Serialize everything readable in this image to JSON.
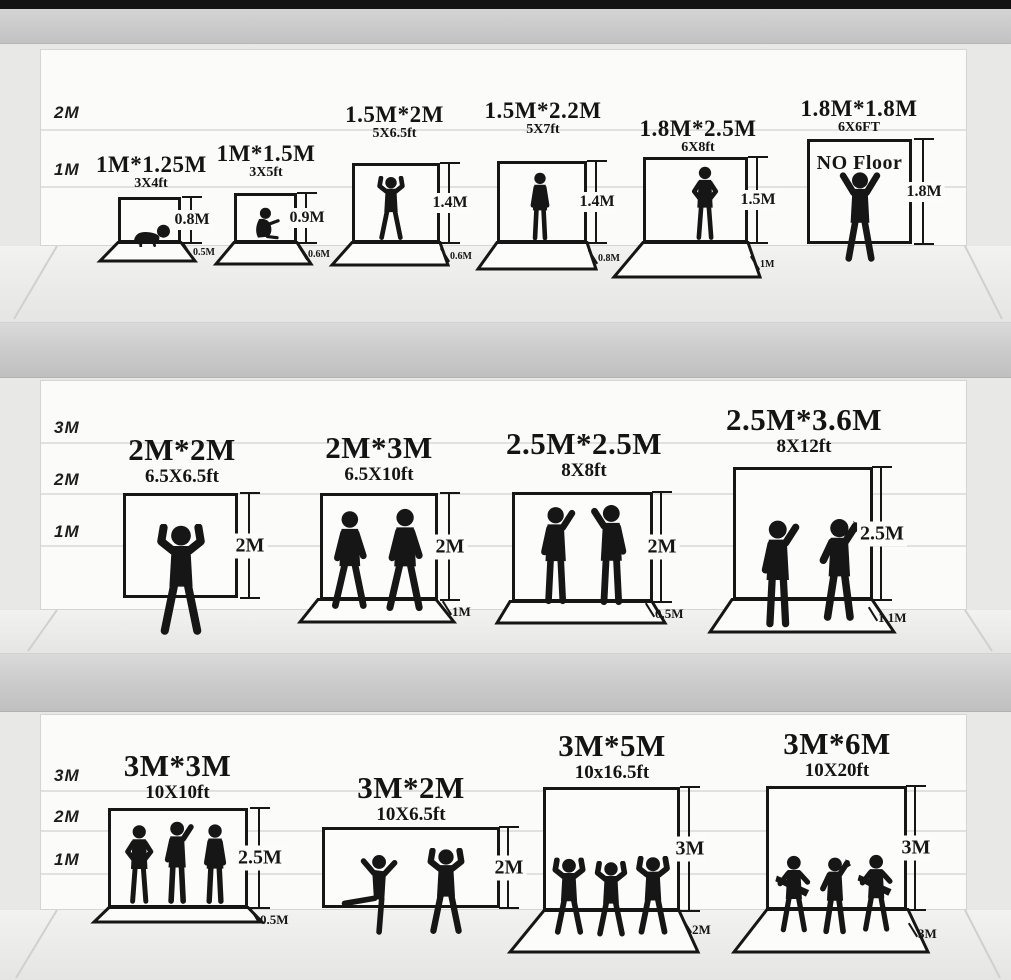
{
  "palette": {
    "ink": "#161616",
    "wall": "#fbfbfa",
    "floor": "#ededeb",
    "divider": "#c9c9c9",
    "side_wall": "#e8e8e6",
    "top_bar": "#121212",
    "grid_line": "#e1e1df"
  },
  "rows": [
    {
      "axis": [
        "2M",
        "1M"
      ],
      "panels": [
        {
          "size_m": "1M*1.25M",
          "size_ft": "3X4ft",
          "height": "0.8M",
          "floor": "0.5M",
          "figure": "baby-crawling"
        },
        {
          "size_m": "1M*1.5M",
          "size_ft": "3X5ft",
          "height": "0.9M",
          "floor": "0.6M",
          "figure": "toddler-sitting"
        },
        {
          "size_m": "1.5M*2M",
          "size_ft": "5X6.5ft",
          "height": "1.4M",
          "floor": "0.6M",
          "figure": "child-arms-raised"
        },
        {
          "size_m": "1.5M*2.2M",
          "size_ft": "5X7ft",
          "height": "1.4M",
          "floor": "0.8M",
          "figure": "boy-standing"
        },
        {
          "size_m": "1.8M*2.5M",
          "size_ft": "6X8ft",
          "height": "1.5M",
          "floor": "1M",
          "figure": "man-hands-on-hips"
        },
        {
          "size_m": "1.8M*1.8M",
          "size_ft": "6X6FT",
          "height": "1.8M",
          "no_floor_note": "NO Floor",
          "figure": "man-arms-up-v"
        }
      ]
    },
    {
      "axis": [
        "3M",
        "2M",
        "1M"
      ],
      "panels": [
        {
          "size_m": "2M*2M",
          "size_ft": "6.5X6.5ft",
          "height": "2M",
          "figure": "man-victory-arms"
        },
        {
          "size_m": "2M*3M",
          "size_ft": "6.5X10ft",
          "height": "2M",
          "floor": "1M",
          "figure": "two-men-walking"
        },
        {
          "size_m": "2.5M*2.5M",
          "size_ft": "8X8ft",
          "height": "2M",
          "floor": "0.5M",
          "figure": "two-men-talking"
        },
        {
          "size_m": "2.5M*3.6M",
          "size_ft": "8X12ft",
          "height": "2.5M",
          "floor": "1.1M",
          "figure": "two-men-posing"
        }
      ]
    },
    {
      "axis": [
        "3M",
        "2M",
        "1M"
      ],
      "panels": [
        {
          "size_m": "3M*3M",
          "size_ft": "10X10ft",
          "height": "2.5M",
          "floor": "0.5M",
          "figure": "three-people-standing"
        },
        {
          "size_m": "3M*2M",
          "size_ft": "10X6.5ft",
          "height": "2M",
          "figure": "two-people-dancing"
        },
        {
          "size_m": "3M*5M",
          "size_ft": "10x16.5ft",
          "height": "3M",
          "floor": "2M",
          "figure": "three-people-cheering"
        },
        {
          "size_m": "3M*6M",
          "size_ft": "10X20ft",
          "height": "3M",
          "floor": "3M",
          "figure": "three-person-band"
        }
      ]
    }
  ]
}
